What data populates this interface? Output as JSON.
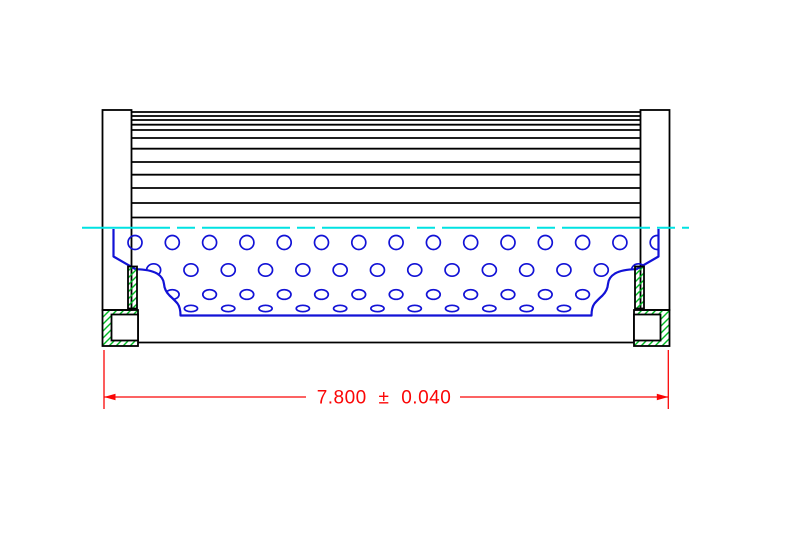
{
  "dimension": {
    "label": "7.800 ± 0.040",
    "value": "7.800",
    "tolerance": "± 0.040"
  },
  "colors": {
    "paper": "#ffffff",
    "outline": "#000000",
    "tube": "#1212d6",
    "centerline": "#00e2e2",
    "hatch": "#00bb22",
    "dimension": "#fb0606"
  },
  "drawing": {
    "pleat_band": {
      "x1": 131.5,
      "x2": 640.5
    },
    "pleat_line_ys": [
      112,
      116,
      120,
      124.7,
      130,
      138,
      148.7,
      162,
      174.7,
      188,
      203,
      217.5
    ],
    "perforations": {
      "step": 37.3,
      "x_max": 660,
      "grids": {
        "A": 135,
        "B": 153.65
      },
      "rows": [
        {
          "grid": "A",
          "cy": 242.5,
          "rx": 7.0,
          "ry": 7.0
        },
        {
          "grid": "B",
          "cy": 270.0,
          "rx": 7.0,
          "ry": 6.2
        },
        {
          "grid": "A",
          "cy": 294.5,
          "rx": 6.8,
          "ry": 4.8
        },
        {
          "grid": "B",
          "cy": 308.5,
          "rx": 6.6,
          "ry": 3.2
        }
      ]
    },
    "profile": {
      "stroke_d": "M 113.5 229 L 113.5 256.5 L 135.5 269.2 Q 150 269.5 157 273.5 Q 163.5 277.5 164 284 Q 164.5 290.5 169.5 295.5 Q 174.5 300 177.5 303.5 Q 180.5 307.5 180.5 315.5 L 591.5 315.5 Q 591.5 307.5 594.5 303.5 Q 597.5 300 602.5 295.5 Q 607.5 290.5 608 284 Q 608.5 277.5 615 273.5 Q 622 269.5 636.5 269.2 L 658.5 256.5 L 658.5 229",
      "clip_d": "M 113.5 227 L 113.5 256.5 L 135.5 269.2 Q 150 269.5 157 273.5 Q 163.5 277.5 164 284 Q 164.5 290.5 169.5 295.5 Q 174.5 300 177.5 303.5 Q 180.5 307.5 180.5 315.5 L 591.5 315.5 Q 591.5 307.5 594.5 303.5 Q 597.5 300 602.5 295.5 Q 607.5 290.5 608 284 Q 608.5 277.5 615 273.5 Q 622 269.5 636.5 269.2 L 658.5 256.5 L 658.5 227 Z"
    },
    "centerline": {
      "y": 227.7,
      "x1": 82,
      "x2": 689,
      "dash": "88 7 18 7"
    }
  }
}
